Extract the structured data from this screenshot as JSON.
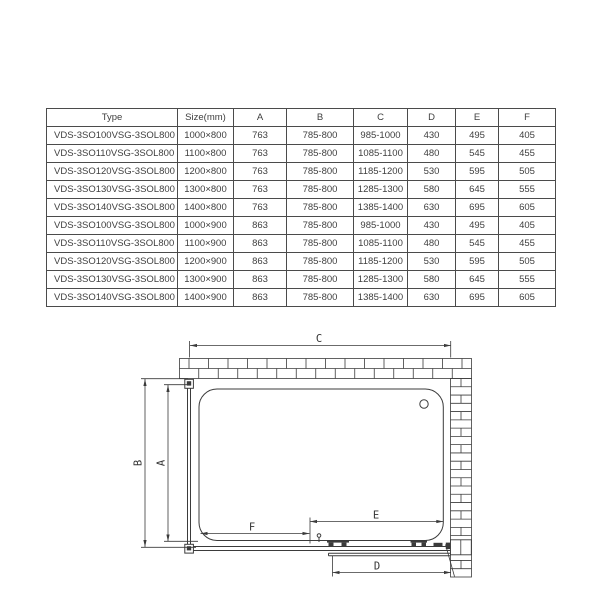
{
  "table": {
    "headers": [
      "Type",
      "Size(mm)",
      "A",
      "B",
      "C",
      "D",
      "E",
      "F"
    ],
    "rows": [
      {
        "type_a": "VDS-3SO100",
        "type_b": "VSG-3SOL800",
        "size": "1000×800",
        "a": "763",
        "b": "785-800",
        "c": "985-1000",
        "d": "430",
        "e": "495",
        "f": "405"
      },
      {
        "type_a": "VDS-3SO110",
        "type_b": "VSG-3SOL800",
        "size": "1100×800",
        "a": "763",
        "b": "785-800",
        "c": "1085-1100",
        "d": "480",
        "e": "545",
        "f": "455"
      },
      {
        "type_a": "VDS-3SO120",
        "type_b": "VSG-3SOL800",
        "size": "1200×800",
        "a": "763",
        "b": "785-800",
        "c": "1185-1200",
        "d": "530",
        "e": "595",
        "f": "505"
      },
      {
        "type_a": "VDS-3SO130",
        "type_b": "VSG-3SOL800",
        "size": "1300×800",
        "a": "763",
        "b": "785-800",
        "c": "1285-1300",
        "d": "580",
        "e": "645",
        "f": "555"
      },
      {
        "type_a": "VDS-3SO140",
        "type_b": "VSG-3SOL800",
        "size": "1400×800",
        "a": "763",
        "b": "785-800",
        "c": "1385-1400",
        "d": "630",
        "e": "695",
        "f": "605"
      },
      {
        "type_a": "VDS-3SO100",
        "type_b": "VSG-3SOL800",
        "size": "1000×900",
        "a": "863",
        "b": "785-800",
        "c": "985-1000",
        "d": "430",
        "e": "495",
        "f": "405"
      },
      {
        "type_a": "VDS-3SO110",
        "type_b": "VSG-3SOL800",
        "size": "1100×900",
        "a": "863",
        "b": "785-800",
        "c": "1085-1100",
        "d": "480",
        "e": "545",
        "f": "455"
      },
      {
        "type_a": "VDS-3SO120",
        "type_b": "VSG-3SOL800",
        "size": "1200×900",
        "a": "863",
        "b": "785-800",
        "c": "1185-1200",
        "d": "530",
        "e": "595",
        "f": "505"
      },
      {
        "type_a": "VDS-3SO130",
        "type_b": "VSG-3SOL800",
        "size": "1300×900",
        "a": "863",
        "b": "785-800",
        "c": "1285-1300",
        "d": "580",
        "e": "645",
        "f": "555"
      },
      {
        "type_a": "VDS-3SO140",
        "type_b": "VSG-3SOL800",
        "size": "1400×900",
        "a": "863",
        "b": "785-800",
        "c": "1385-1400",
        "d": "630",
        "e": "695",
        "f": "605"
      }
    ]
  },
  "diagram": {
    "labels": {
      "c": "C",
      "b": "B",
      "a": "A",
      "f": "F",
      "e": "E",
      "d": "D"
    }
  },
  "colors": {
    "line": "#3b3b3b",
    "text": "#3e3e3e"
  }
}
